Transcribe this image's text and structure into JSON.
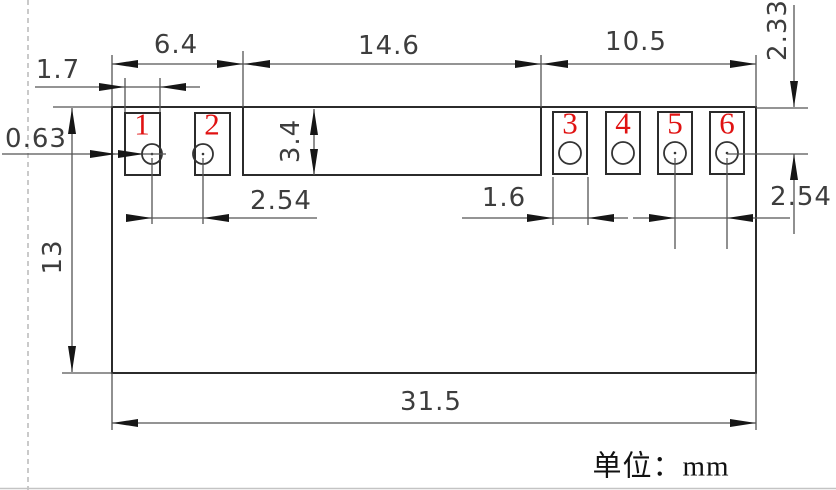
{
  "drawing": {
    "unit_note": "单位：mm",
    "pads": [
      {
        "number": "1"
      },
      {
        "number": "2"
      },
      {
        "number": "3"
      },
      {
        "number": "4"
      },
      {
        "number": "5"
      },
      {
        "number": "6"
      }
    ],
    "dimensions": {
      "section_left_width": "6.4",
      "section_middle_width": "14.6",
      "section_right_width": "10.5",
      "pad_width_left": "1.7",
      "edge_to_pad_offset": "0.63",
      "slot_depth": "3.4",
      "top_edge_to_hole": "2.33",
      "hole_pitch_left": "2.54",
      "pad_width_right": "1.6",
      "hole_pitch_right": "2.54",
      "body_height": "13",
      "body_width": "31.5"
    },
    "colors": {
      "pad_number": "#e01212",
      "outline": "#2b2b2b",
      "dimension_line": "#555555",
      "background": "#ffffff"
    }
  }
}
